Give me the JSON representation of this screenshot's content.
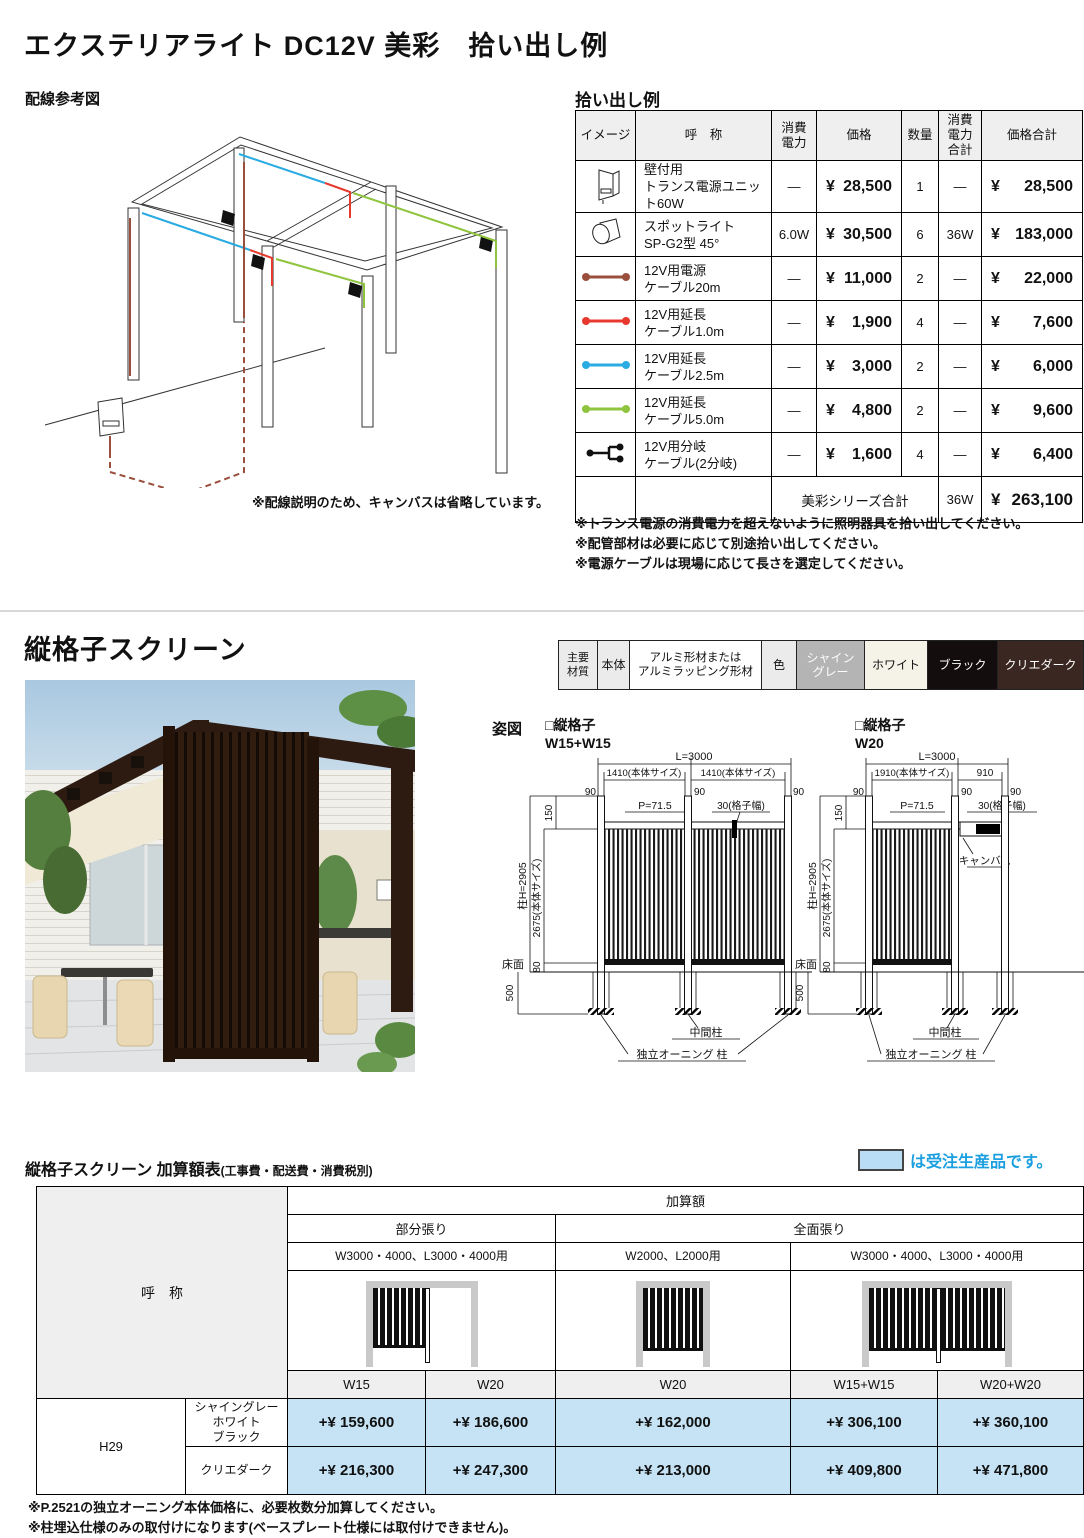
{
  "colors": {
    "cable_brown": "#9a4f3c",
    "cable_red": "#e8392f",
    "cable_cyan": "#2aabe2",
    "cable_green": "#8fc43f",
    "order_blue": "#c5e3f5",
    "legend_blue": "#1b9fe0",
    "chip_gray": "#b4b4b4",
    "chip_white": "#f5f3e8",
    "chip_black": "#140d0d",
    "chip_dark": "#3b2721"
  },
  "s1": {
    "title": "エクステリアライト DC12V 美彩　拾い出し例",
    "wiring_heading": "配線参考図",
    "wiring_caption": "※配線説明のため、キャンバスは省略しています。",
    "pickup_heading": "拾い出し例",
    "cols": {
      "image": "イメージ",
      "name": "呼　称",
      "watt": "消費\n電力",
      "price": "価格",
      "qty": "数量",
      "watt_total": "消費\n電力\n合計",
      "price_total": "価格合計"
    },
    "rows": [
      {
        "icon": "wall-transformer",
        "name": "壁付用\nトランス電源ユニット60W",
        "watt": "—",
        "yen": "¥",
        "price": "28,500",
        "qty": "1",
        "watt_sum": "—",
        "yen2": "¥",
        "total": "28,500"
      },
      {
        "icon": "spotlight",
        "name": "スポットライト\nSP-G2型 45°",
        "watt": "6.0W",
        "yen": "¥",
        "price": "30,500",
        "qty": "6",
        "watt_sum": "36W",
        "yen2": "¥",
        "total": "183,000"
      },
      {
        "icon": "power-cable-20m",
        "name": "12V用電源\nケーブル20m",
        "watt": "—",
        "yen": "¥",
        "price": "11,000",
        "qty": "2",
        "watt_sum": "—",
        "yen2": "¥",
        "total": "22,000"
      },
      {
        "icon": "ext-cable-1.0m",
        "name": "12V用延長\nケーブル1.0m",
        "watt": "—",
        "yen": "¥",
        "price": "1,900",
        "qty": "4",
        "watt_sum": "—",
        "yen2": "¥",
        "total": "7,600"
      },
      {
        "icon": "ext-cable-2.5m",
        "name": "12V用延長\nケーブル2.5m",
        "watt": "—",
        "yen": "¥",
        "price": "3,000",
        "qty": "2",
        "watt_sum": "—",
        "yen2": "¥",
        "total": "6,000"
      },
      {
        "icon": "ext-cable-5.0m",
        "name": "12V用延長\nケーブル5.0m",
        "watt": "—",
        "yen": "¥",
        "price": "4,800",
        "qty": "2",
        "watt_sum": "—",
        "yen2": "¥",
        "total": "9,600"
      },
      {
        "icon": "branch-cable",
        "name": "12V用分岐\nケーブル(2分岐)",
        "watt": "—",
        "yen": "¥",
        "price": "1,600",
        "qty": "4",
        "watt_sum": "—",
        "yen2": "¥",
        "total": "6,400"
      }
    ],
    "total_row": {
      "label": "美彩シリーズ合計",
      "watt": "36W",
      "yen": "¥",
      "amount": "263,100"
    },
    "notes": [
      "※トランス電源の消費電力を超えないように照明器具を拾い出してください。",
      "※配管部材は必要に応じて別途拾い出してください。",
      "※電源ケーブルは現場に応じて長さを選定してください。"
    ]
  },
  "s2": {
    "title": "縦格子スクリーン",
    "materials": {
      "m1": "主要\n材質",
      "m2": "本体",
      "m3": "アルミ形材または\nアルミラッピング形材",
      "m4": "色",
      "c1": "シャイン\nグレー",
      "c2": "ホワイト",
      "c3": "ブラック",
      "c4": "クリエダーク"
    },
    "sugata": "姿図",
    "zu1": {
      "title": "□縦格子",
      "size": "W15+W15",
      "L": "L=3000",
      "b1": "1410(本体サイズ)",
      "b2": "1410(本体サイズ)",
      "n90": "90",
      "pitch": "P=71.5",
      "width30": "30(格子幅)",
      "d150": "150",
      "post": "柱H=2905",
      "bodyh": "2675(本体サイズ)",
      "d80": "80",
      "floor": "床面",
      "d500": "500",
      "mid": "中間柱",
      "awning": "独立オーニング 柱"
    },
    "zu2": {
      "title": "□縦格子",
      "size": "W20",
      "L": "L=3000",
      "b1": "1910(本体サイズ)",
      "b2": "910",
      "n90": "90",
      "pitch": "P=71.5",
      "width30": "30(格子幅)",
      "canvas": "キャンバス",
      "d150": "150",
      "post": "柱H=2905",
      "bodyh": "2675(本体サイズ)",
      "d80": "80",
      "floor": "床面",
      "d500": "500",
      "mid": "中間柱",
      "awning": "独立オーニング 柱"
    }
  },
  "s3": {
    "title": "縦格子スクリーン 加算額表",
    "title_sub": "(工事費・配送費・消費税別)",
    "legend": "は受注生産品です。",
    "kasangaku": "加算額",
    "bubun": "部分張り",
    "zenmen": "全面張り",
    "use1": "W3000・4000、L3000・4000用",
    "use2": "W2000、L2000用",
    "use3": "W3000・4000、L3000・4000用",
    "kosho": "呼　称",
    "sizes": [
      "W15",
      "W20",
      "W20",
      "W15+W15",
      "W20+W20"
    ],
    "h29": "H29",
    "colors_row1": "シャイングレー\nホワイト\nブラック",
    "colors_row2": "クリエダーク",
    "prices_row1": [
      "+¥ 159,600",
      "+¥ 186,600",
      "+¥ 162,000",
      "+¥ 306,100",
      "+¥ 360,100"
    ],
    "prices_row2": [
      "+¥ 216,300",
      "+¥ 247,300",
      "+¥ 213,000",
      "+¥ 409,800",
      "+¥ 471,800"
    ],
    "notes": [
      "※P.2521の独立オーニング本体価格に、必要枚数分加算してください。",
      "※柱埋込仕様のみの取付けになります(ベースプレート仕様には取付けできません)。"
    ]
  }
}
